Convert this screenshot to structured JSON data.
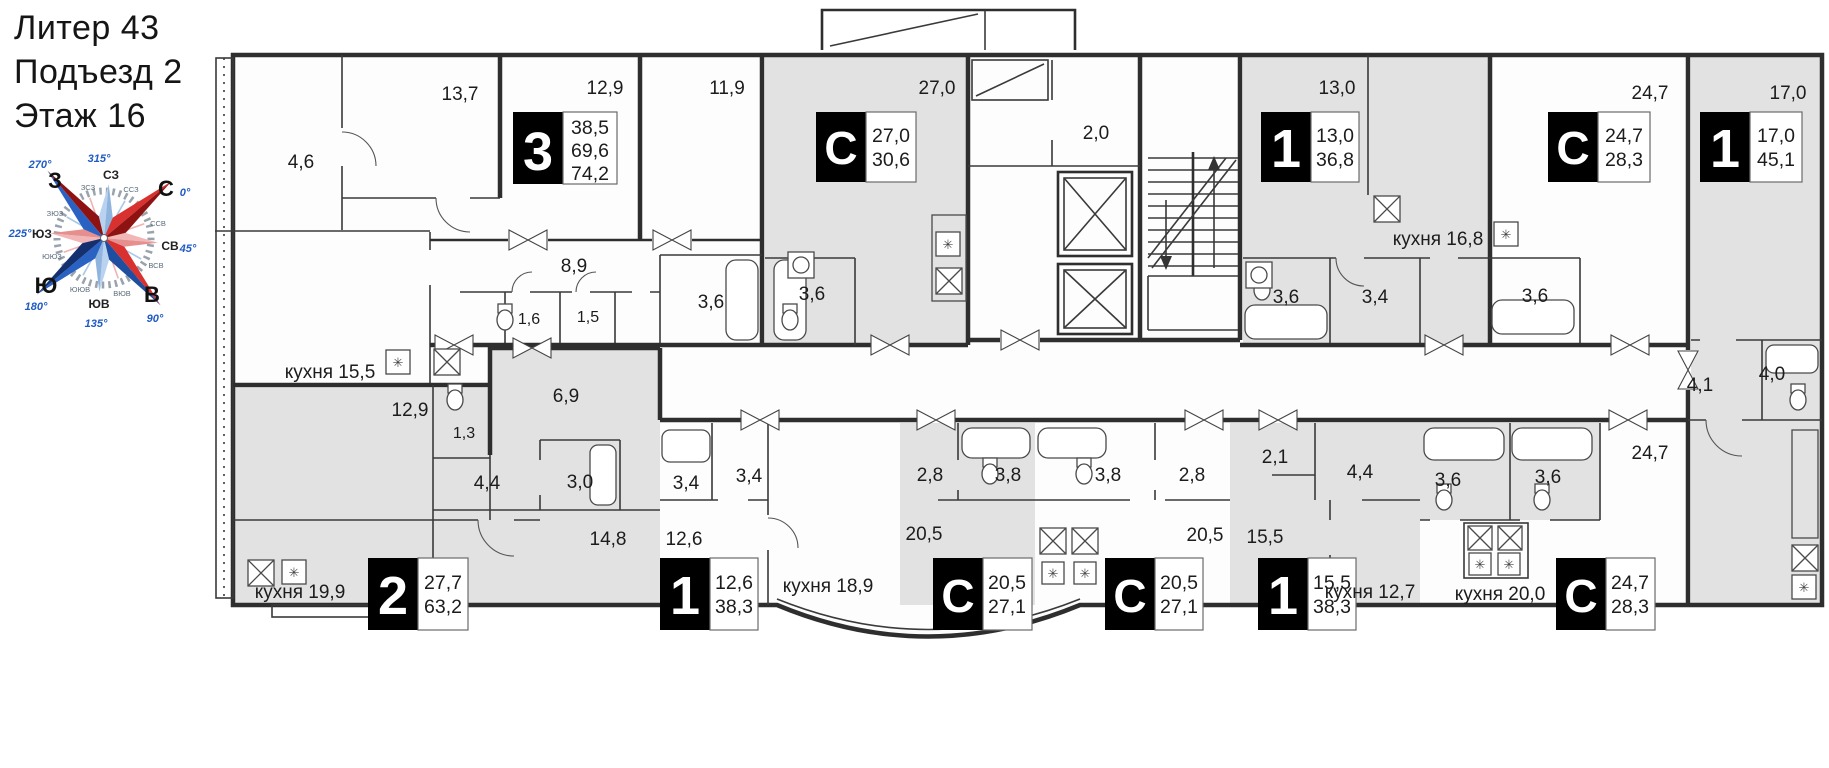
{
  "header": {
    "building": "Литер 43",
    "entrance": "Подъезд 2",
    "floor": "Этаж 16"
  },
  "compass": {
    "n": "С",
    "e": "В",
    "s": "Ю",
    "w": "З",
    "ne": "СВ",
    "se": "ЮВ",
    "sw": "ЮЗ",
    "nw": "СЗ",
    "nne": "ССВ",
    "ene": "ВСВ",
    "ese": "ВЮВ",
    "sse": "ЮЮВ",
    "ssw": "ЮЮЗ",
    "wsw": "ЗЮЗ",
    "wnw": "ЗСЗ",
    "nnw": "ССЗ",
    "deg0": "0°",
    "deg45": "45°",
    "deg90": "90°",
    "deg135": "135°",
    "deg180": "180°",
    "deg225": "225°",
    "deg270": "270°",
    "deg315": "315°"
  },
  "badges": {
    "apt3": {
      "type": "3",
      "a1": "38,5",
      "a2": "69,6",
      "a3": "74,2"
    },
    "studio1": {
      "type": "С",
      "a1": "27,0",
      "a2": "30,6"
    },
    "apt1t": {
      "type": "1",
      "a1": "13,0",
      "a2": "36,8"
    },
    "studio2": {
      "type": "С",
      "a1": "24,7",
      "a2": "28,3"
    },
    "apt1r": {
      "type": "1",
      "a1": "17,0",
      "a2": "45,1"
    },
    "apt2": {
      "type": "2",
      "a1": "27,7",
      "a2": "63,2"
    },
    "apt1bl": {
      "type": "1",
      "a1": "12,6",
      "a2": "38,3"
    },
    "studio3": {
      "type": "С",
      "a1": "20,5",
      "a2": "27,1"
    },
    "studio4": {
      "type": "С",
      "a1": "20,5",
      "a2": "27,1"
    },
    "apt1br": {
      "type": "1",
      "a1": "15,5",
      "a2": "38,3"
    },
    "studio5": {
      "type": "С",
      "a1": "24,7",
      "a2": "28,3"
    }
  },
  "rooms": {
    "balcony46": "4,6",
    "room137": "13,7",
    "room129t": "12,9",
    "room119": "11,9",
    "hall89": "8,9",
    "wc16": "1,6",
    "store15": "1,5",
    "bath36a": "3,6",
    "kitchen155": "кухня 15,5",
    "room270": "27,0",
    "bath36b": "3,6",
    "lobby20": "2,0",
    "room130": "13,0",
    "bath36c": "3,6",
    "hall34a": "3,4",
    "kitchen168": "кухня 16,8",
    "room247t": "24,7",
    "bath36d": "3,6",
    "room170": "17,0",
    "hall41": "4,1",
    "bath40": "4,0",
    "kitchen200": "кухня 20,0",
    "room129b": "12,9",
    "wc13": "1,3",
    "hall69": "6,9",
    "hall44a": "4,4",
    "bath30": "3,0",
    "room148": "14,8",
    "kitchen199": "кухня 19,9",
    "room126": "12,6",
    "bath34c": "3,4",
    "hall34b": "3,4",
    "kitchen189": "кухня 18,9",
    "hall28a": "2,8",
    "bath38a": "3,8",
    "room205a": "20,5",
    "bath38b": "3,8",
    "hall28b": "2,8",
    "room205b": "20,5",
    "hall21": "2,1",
    "hall44b": "4,4",
    "room155": "15,5",
    "kitchen127": "кухня 12,7",
    "bath36e": "3,6",
    "bath36f": "3,6",
    "room247b": "24,7"
  }
}
